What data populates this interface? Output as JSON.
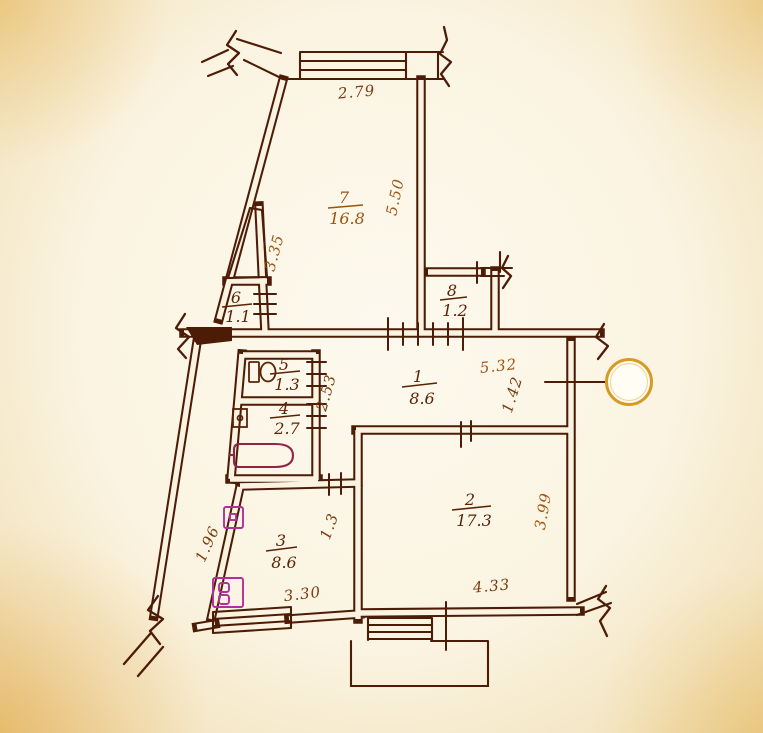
{
  "document": {
    "kind": "apartment floor plan (scanned hand-drawn)"
  },
  "rooms": [
    {
      "number": "7",
      "area": "16.8"
    },
    {
      "number": "8",
      "area": "1.2"
    },
    {
      "number": "6",
      "area": "1.1"
    },
    {
      "number": "5",
      "area": "1.3"
    },
    {
      "number": "4",
      "area": "2.7"
    },
    {
      "number": "1",
      "area": "8.6"
    },
    {
      "number": "2",
      "area": "17.3"
    },
    {
      "number": "3",
      "area": "8.6"
    }
  ],
  "dimensions": [
    {
      "value": "2.79"
    },
    {
      "value": "5.50"
    },
    {
      "value": "3.35"
    },
    {
      "value": "5.32"
    },
    {
      "value": "1.42"
    },
    {
      "value": "2.53"
    },
    {
      "value": "3.99"
    },
    {
      "value": "4.33"
    },
    {
      "value": "3.30"
    },
    {
      "value": "1.96"
    },
    {
      "value": "1.3"
    }
  ],
  "fixtures": [
    "toilet-icon",
    "washbasin-icon",
    "bathtub-icon",
    "kitchen-sink-icon",
    "stove-icon"
  ],
  "symbols": [
    "window-hatch",
    "door-opening-ticks",
    "wall-break-squiggle",
    "punch-hole-circle"
  ],
  "colors": {
    "paper": "#fbf3e2",
    "ink": "#4d1c07",
    "label_ink": "#5c2206",
    "dim_ink": "#a05512",
    "fixture_magenta": "#b0309a",
    "bathtub_ink": "#932248",
    "punch_ring": "#d79a26"
  }
}
